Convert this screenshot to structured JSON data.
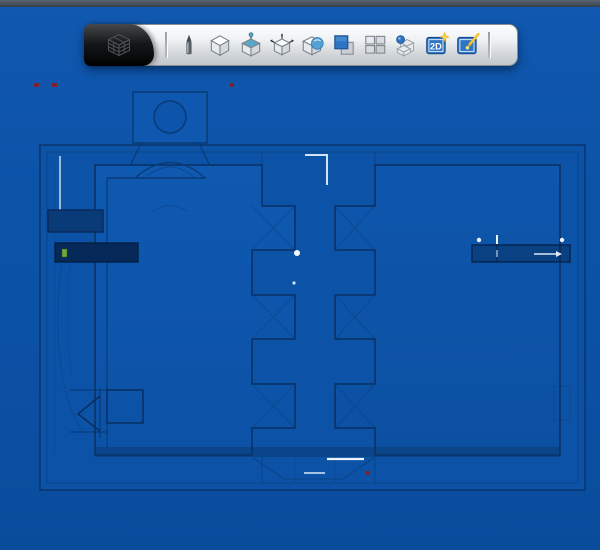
{
  "window": {
    "top_strip_color": "#46525E",
    "canvas_background": "#0B51A5"
  },
  "toolbar": {
    "logo_icon": "wireframe-cube-logo-icon",
    "buttons": [
      {
        "id": "markup-pen",
        "icon": "pen-icon"
      },
      {
        "id": "view-isometric",
        "icon": "iso-cube-icon"
      },
      {
        "id": "view-pin",
        "icon": "cube-pin-icon"
      },
      {
        "id": "view-axes",
        "icon": "cube-axes-icon"
      },
      {
        "id": "view-rotate",
        "icon": "cube-rotate-icon"
      },
      {
        "id": "shaded-overlay",
        "icon": "overlapping-squares-icon"
      },
      {
        "id": "viewport-grid",
        "icon": "four-panes-icon"
      },
      {
        "id": "components",
        "icon": "cube-stack-sphere-icon"
      },
      {
        "id": "new-2d-sheet",
        "icon": "sheet-2d-star-icon",
        "label": "2D"
      },
      {
        "id": "image-markup",
        "icon": "image-pen-icon"
      }
    ]
  },
  "viewport": {
    "outline_color": "#09366F",
    "panel_fill": "#0D55AB",
    "highlight_color": "#E8F1FA",
    "marker_red": "#8E1B1B",
    "note_green": "#71A63C",
    "accent_blue_icon": "#2E76C4",
    "star_yellow": "#FFD34D"
  }
}
